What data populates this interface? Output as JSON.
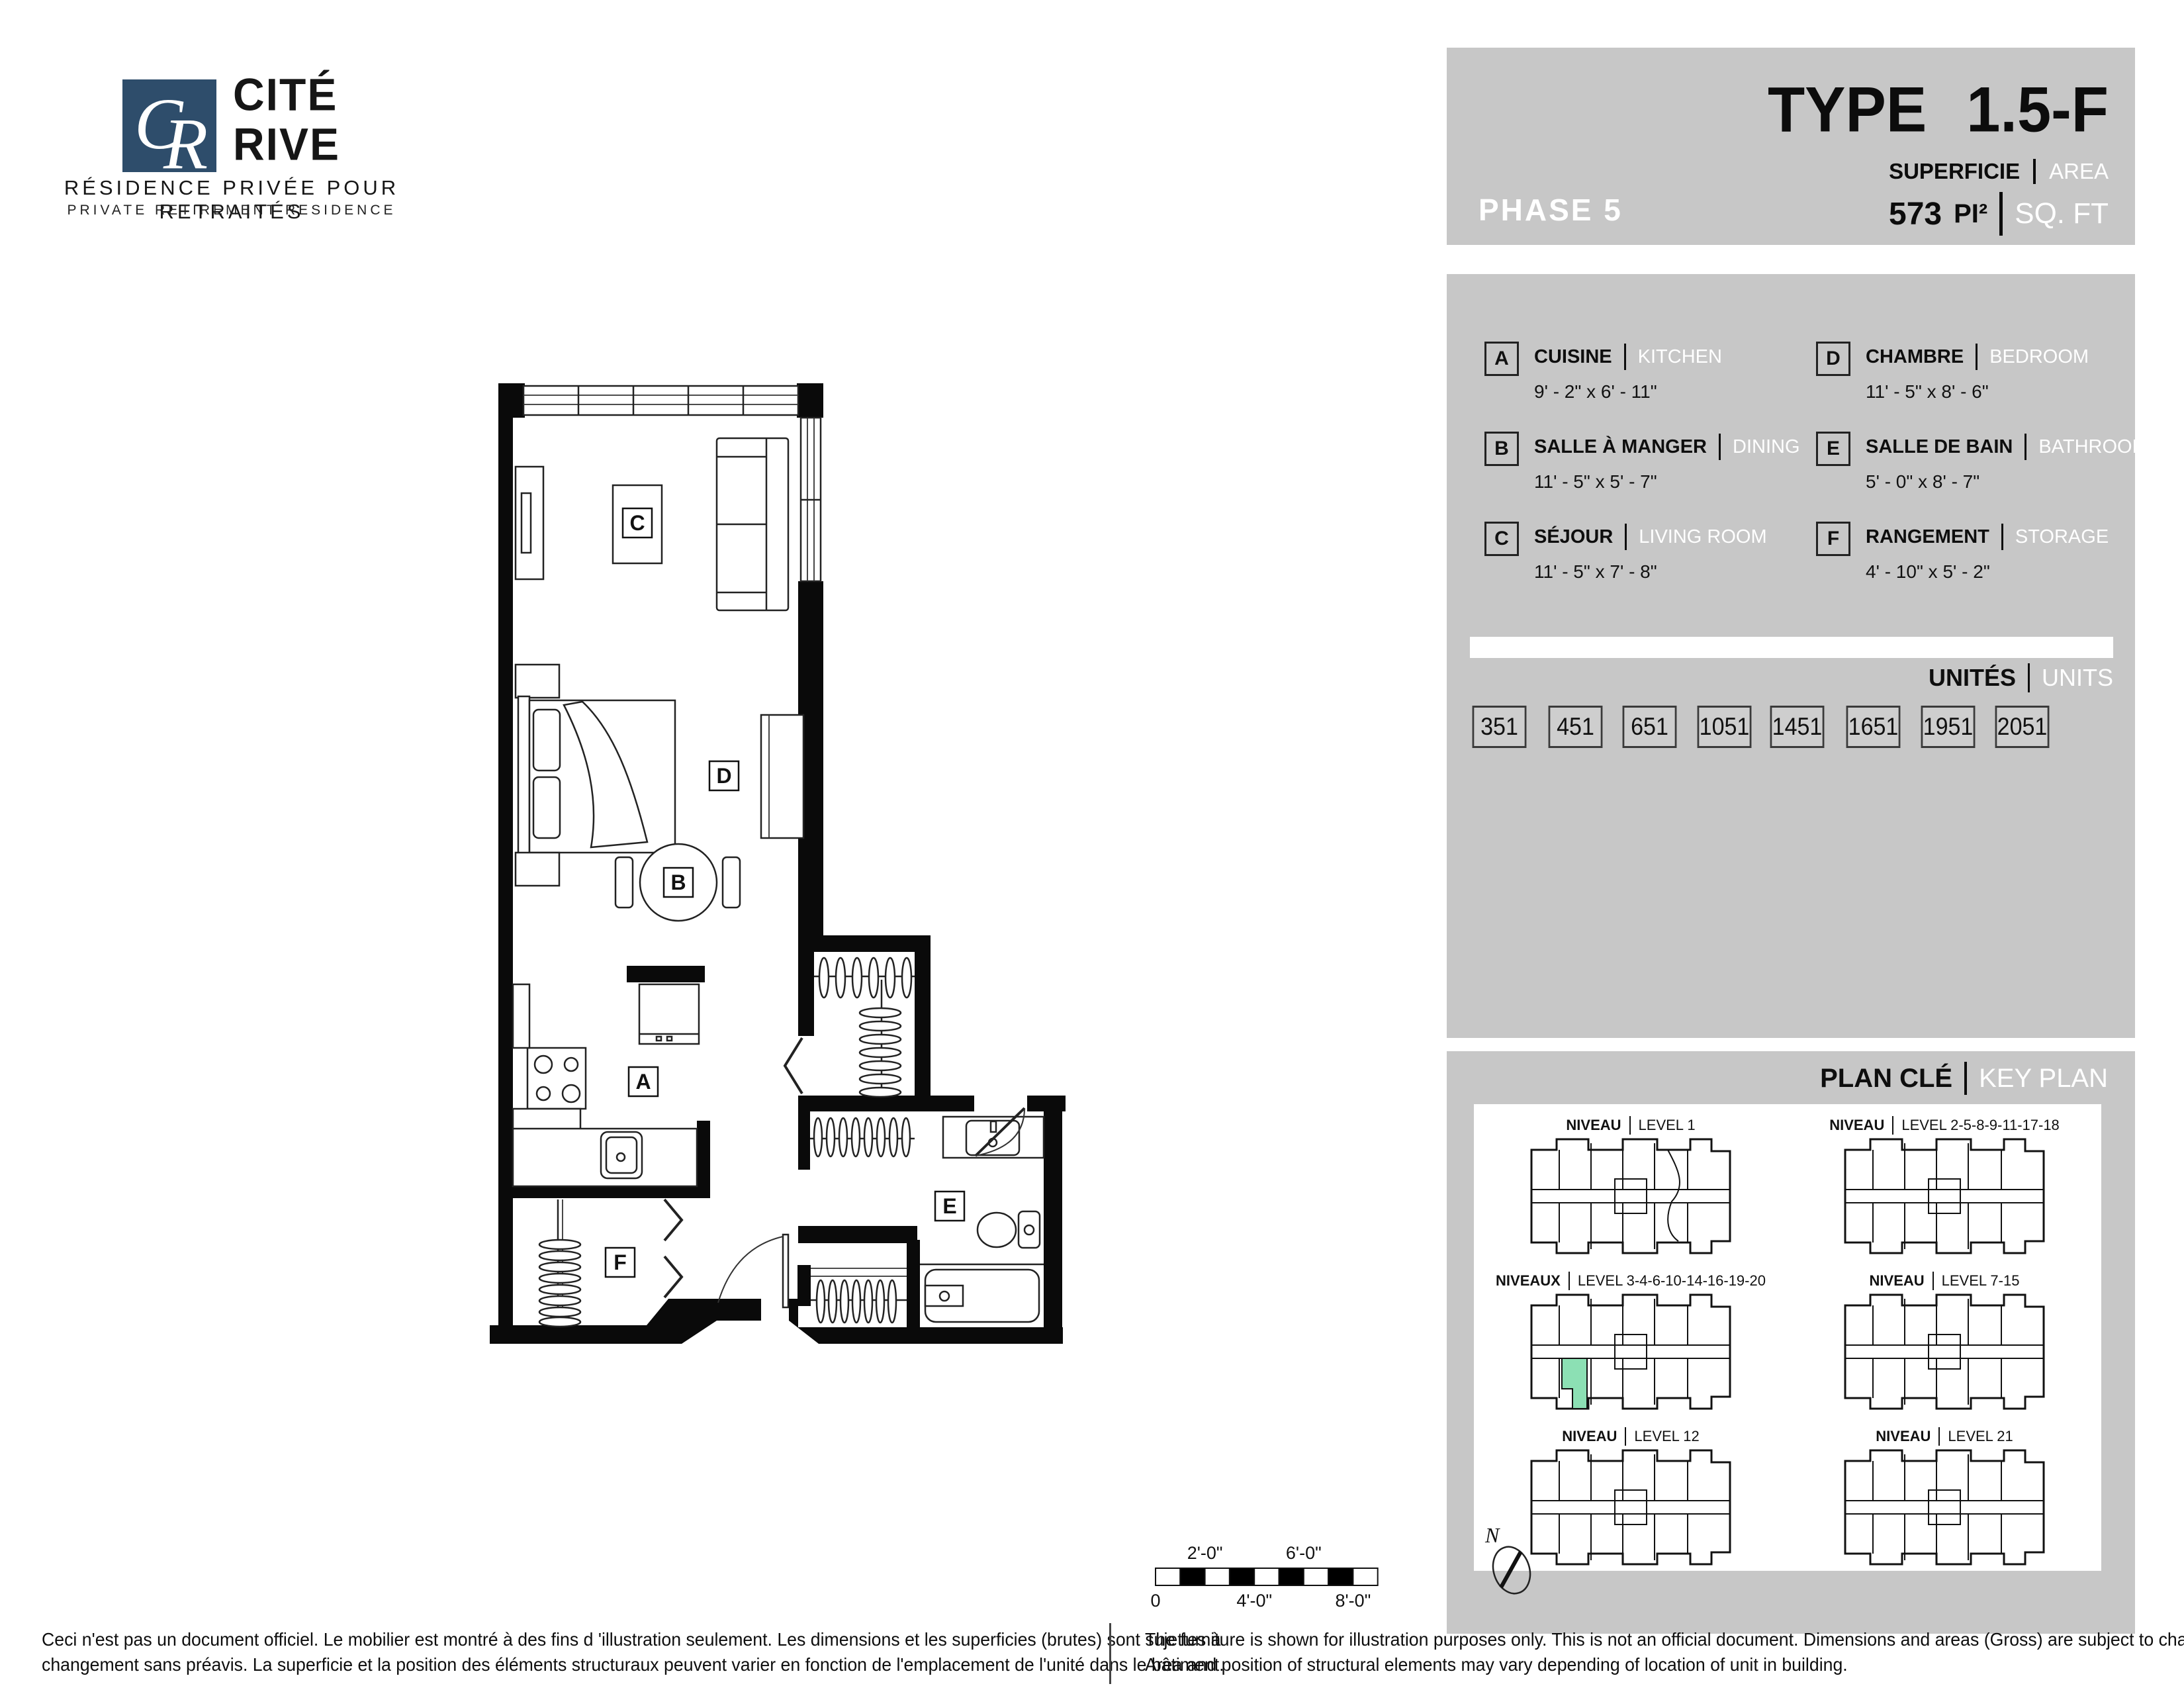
{
  "colors": {
    "panel_gray": "#c7c7c7",
    "brand_navy": "#2e4d6b",
    "highlight_green": "#8ce0b4"
  },
  "logo": {
    "c": "C",
    "r": "R",
    "name_line1": "CITÉ",
    "name_line2": "RIVE",
    "subtitle_fr": "RÉSIDENCE PRIVÉE POUR RETRAITÉS",
    "subtitle_en": "PRIVATE RETIREMENT RESIDENCE"
  },
  "header": {
    "phase": "PHASE 5",
    "type_label": "TYPE",
    "type_value": "1.5-F",
    "area_label_fr": "SUPERFICIE",
    "area_label_en": "AREA",
    "area_value": "573",
    "area_unit_fr": "PI²",
    "area_unit_en": "SQ. FT"
  },
  "legend": {
    "rooms": [
      {
        "key": "A",
        "fr": "CUISINE",
        "en": "KITCHEN",
        "dims": "9' - 2\" x 6' - 11\""
      },
      {
        "key": "B",
        "fr": "SALLE À MANGER",
        "en": "DINING",
        "dims": "11' - 5\" x 5' - 7\""
      },
      {
        "key": "C",
        "fr": "SÉJOUR",
        "en": "LIVING ROOM",
        "dims": "11' - 5\" x 7' - 8\""
      },
      {
        "key": "D",
        "fr": "CHAMBRE",
        "en": "BEDROOM",
        "dims": "11' - 5\" x 8' - 6\""
      },
      {
        "key": "E",
        "fr": "SALLE DE BAIN",
        "en": "BATHROOM",
        "dims": "5' - 0\" x 8' - 7\""
      },
      {
        "key": "F",
        "fr": "RANGEMENT",
        "en": "STORAGE",
        "dims": "4' - 10\" x 5' - 2\""
      }
    ]
  },
  "units": {
    "title_fr": "UNITÉS",
    "title_en": "UNITS",
    "numbers": [
      "351",
      "451",
      "651",
      "1051",
      "1451",
      "1651",
      "1951",
      "2051"
    ]
  },
  "key_plan": {
    "title_fr": "PLAN CLÉ",
    "title_en": "KEY PLAN",
    "north_label": "N",
    "levels": [
      {
        "fr": "NIVEAU",
        "en": "LEVEL 1"
      },
      {
        "fr": "NIVEAU",
        "en": "LEVEL 2-5-8-9-11-17-18"
      },
      {
        "fr": "NIVEAUX",
        "en": "LEVEL 3-4-6-10-14-16-19-20"
      },
      {
        "fr": "NIVEAU",
        "en": "LEVEL 7-15"
      },
      {
        "fr": "NIVEAU",
        "en": "LEVEL 12"
      },
      {
        "fr": "NIVEAU",
        "en": "LEVEL 21"
      }
    ]
  },
  "plan": {
    "room_labels": [
      "A",
      "B",
      "C",
      "D",
      "E",
      "F"
    ]
  },
  "scale_bar": {
    "above_1": "2'-0\"",
    "above_2": "6'-0\"",
    "below_0": "0",
    "below_1": "4'-0\"",
    "below_2": "8'-0\""
  },
  "footer": {
    "fr_line1": "Ceci n'est pas un document officiel.  Le mobilier est montré à des fins d 'illustration seulement.  Les dimensions et les superficies (brutes) sont sujettes à",
    "fr_line2": "changement sans préavis. La superficie et la position des éléments structuraux peuvent varier en fonction de l'emplacement de l'unité dans le bâtiment.",
    "en_line1": "The furniture is shown for illustration purposes only.  This is not an official document.  Dimensions and areas (Gross) are subject to change without notice.",
    "en_line2": "Area and position of structural elements may vary depending of location of unit in building."
  }
}
